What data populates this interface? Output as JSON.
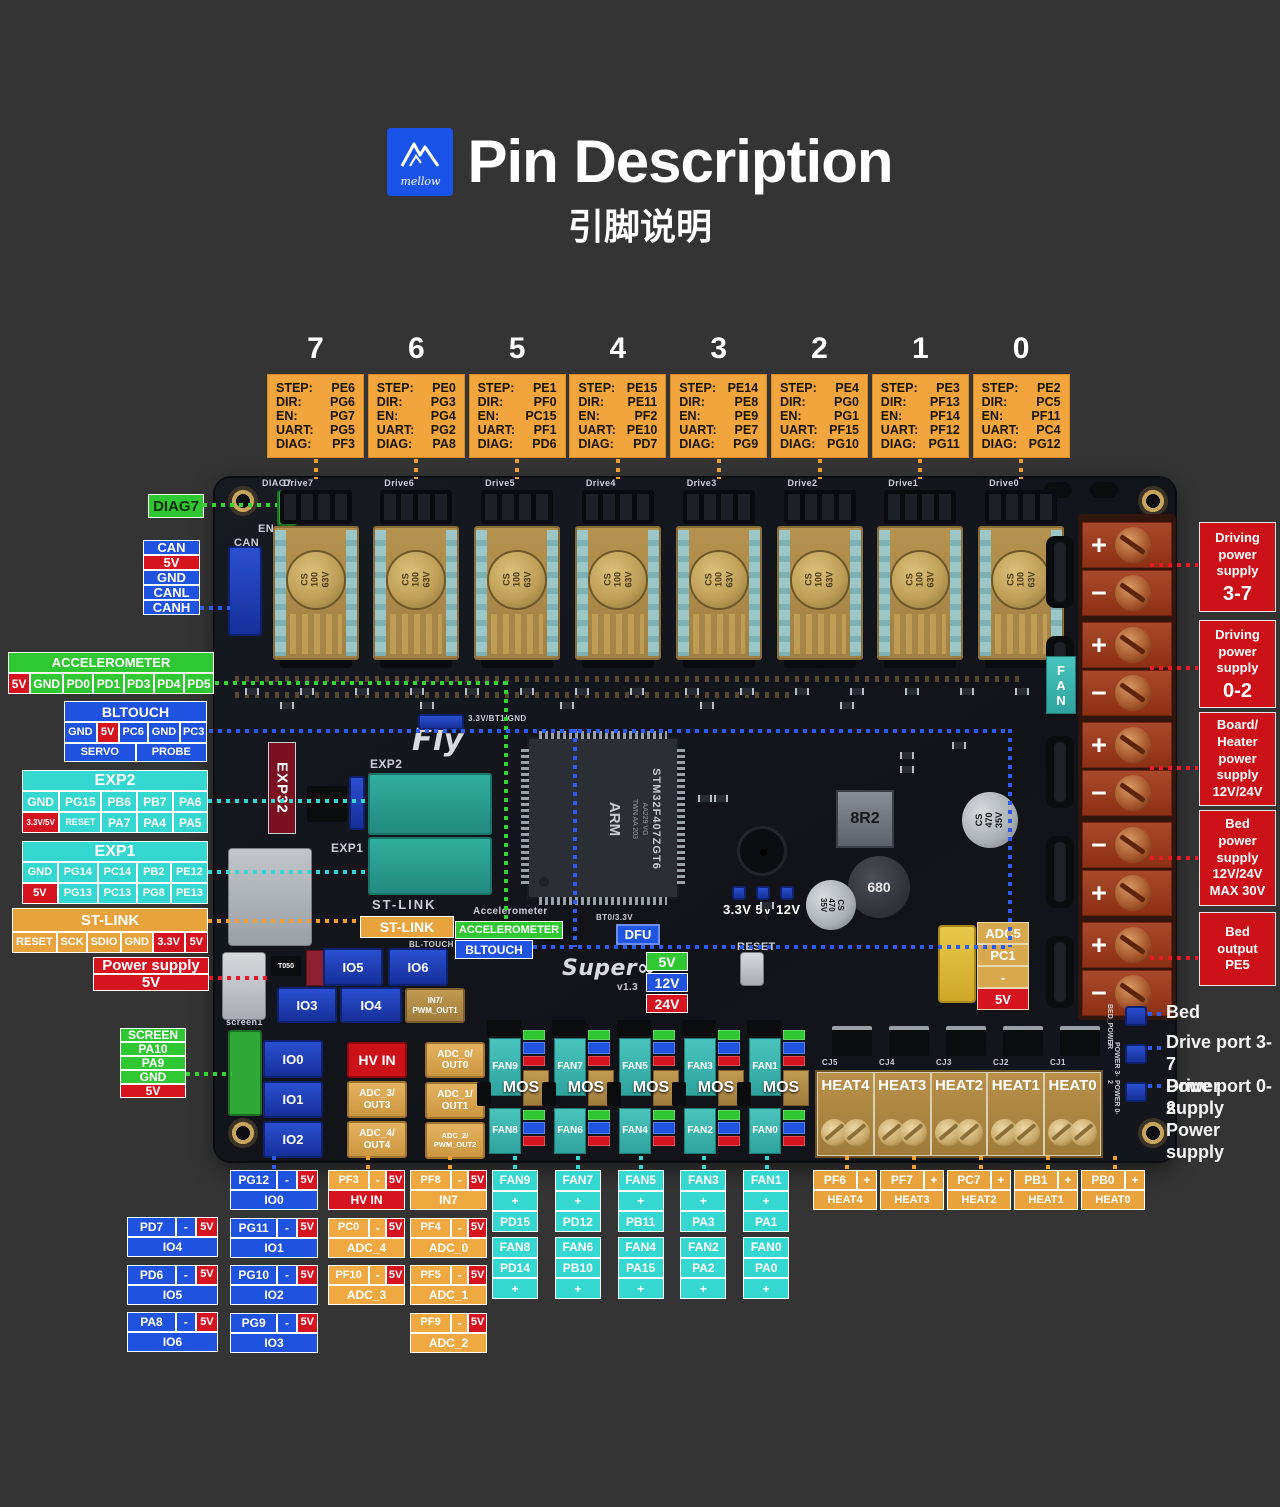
{
  "header": {
    "logo_text": "mellow",
    "title": "Pin Description",
    "subtitle": "引脚说明"
  },
  "drivers": {
    "row_labels": [
      "STEP:",
      "DIR:",
      "EN:",
      "UART:",
      "DIAG:"
    ],
    "items": [
      {
        "num": "7",
        "pins": [
          "PE6",
          "PG6",
          "PG7",
          "PG5",
          "PF3"
        ]
      },
      {
        "num": "6",
        "pins": [
          "PE0",
          "PG3",
          "PG4",
          "PG2",
          "PA8"
        ]
      },
      {
        "num": "5",
        "pins": [
          "PE1",
          "PF0",
          "PC15",
          "PF1",
          "PD6"
        ]
      },
      {
        "num": "4",
        "pins": [
          "PE15",
          "PE11",
          "PF2",
          "PE10",
          "PD7"
        ]
      },
      {
        "num": "3",
        "pins": [
          "PE14",
          "PE8",
          "PE9",
          "PE7",
          "PG9"
        ]
      },
      {
        "num": "2",
        "pins": [
          "PE4",
          "PG0",
          "PG1",
          "PF15",
          "PG10"
        ]
      },
      {
        "num": "1",
        "pins": [
          "PE3",
          "PF13",
          "PF14",
          "PF12",
          "PG11"
        ]
      },
      {
        "num": "0",
        "pins": [
          "PE2",
          "PC5",
          "PF11",
          "PC4",
          "PG12"
        ]
      }
    ]
  },
  "callouts_left": {
    "diag7": "DIAG7",
    "can": [
      "CAN",
      "5V",
      "GND",
      "CANL",
      "CANH"
    ],
    "accelerometer": {
      "title": "ACCELEROMETER",
      "cells": [
        "5V",
        "GND",
        "PD0",
        "PD1",
        "PD3",
        "PD4",
        "PD5"
      ]
    },
    "bltouch": {
      "title": "BLTOUCH",
      "cells": [
        "GND",
        "5V",
        "PC6",
        "GND",
        "PC3"
      ],
      "functions": [
        "SERVO",
        "PROBE"
      ]
    },
    "exp2": {
      "title": "EXP2",
      "row1": [
        "GND",
        "PG15",
        "PB6",
        "PB7",
        "PA6"
      ],
      "row2": [
        "3.3V/5V",
        "RESET",
        "PA7",
        "PA4",
        "PA5"
      ]
    },
    "exp1": {
      "title": "EXP1",
      "row1": [
        "GND",
        "PG14",
        "PC14",
        "PB2",
        "PE12"
      ],
      "row2": [
        "5V",
        "PG13",
        "PC13",
        "PG8",
        "PE13"
      ]
    },
    "stlink": {
      "title": "ST-LINK",
      "cells": [
        "RESET",
        "SCK",
        "SDIO",
        "GND",
        "3.3V",
        "5V"
      ]
    },
    "power_supply": {
      "title": "Power supply",
      "value": "5V"
    },
    "screen": [
      "SCREEN",
      "PA10",
      "PA9",
      "GND",
      "5V"
    ]
  },
  "callouts_right": {
    "boxes": [
      {
        "text": "Driving\npower\nsupply",
        "big": "3-7"
      },
      {
        "text": "Driving\npower\nsupply",
        "big": "0-2"
      },
      {
        "text": "Board/\nHeater\npower\nsupply\n12V/24V",
        "big": ""
      },
      {
        "text": "Bed\npower\nsupply\n12V/24V\nMAX 30V",
        "big": ""
      },
      {
        "text": "Bed\noutput\nPE5",
        "big": ""
      }
    ],
    "notes": [
      {
        "text": "Bed"
      },
      {
        "text": "Drive port 3-7\nPower supply"
      },
      {
        "text": "Drive port 0-2\nPower supply"
      }
    ]
  },
  "board": {
    "socket_labels": [
      "Drive7",
      "Drive6",
      "Drive5",
      "Drive4",
      "Drive3",
      "Drive2",
      "Drive1",
      "Drive0"
    ],
    "diag7_silk": "DIAG7",
    "en_silk": "EN",
    "can_silk": "CAN",
    "cap_lines": "CS\n100\n63V",
    "fan_tab": "FAN",
    "exp32": "EXP32",
    "fly": "Fly",
    "exp2_silk": "EXP2",
    "exp1_silk": "EXP1",
    "jumper_silk": "3.3V/BT1/GND",
    "chip": {
      "marking": "STM32F407ZGT6",
      "sub": "AA229 VG\nTWN AA 203",
      "arm": "ARM"
    },
    "stlink_silk": "ST-LINK",
    "stlink_label": "ST-LINK",
    "accel_silk": "Accelerometer",
    "accel_label": "ACCELEROMETER",
    "bltouch_silk": "BL-TOUCH",
    "bltouch_label": "BLTOUCH",
    "leds_label": "3.3V 5V 12V",
    "dfu_silk": "BT0/3.3V",
    "dfu_label": "DFU",
    "reset_silk": "RESET",
    "super_silk": "Super∞",
    "version_silk": "v1.3",
    "voltage_options": [
      "5V",
      "12V",
      "24V"
    ],
    "adc5_cells": [
      "ADC5",
      "PC1",
      "-",
      "5V"
    ],
    "inductor1": "8R2",
    "inductor2": "680",
    "cap470": "CS\n470\n35V",
    "t050": "T050",
    "screen_silk": "screen1",
    "io_connectors": [
      "IO0",
      "IO1",
      "IO2",
      "IO3",
      "IO4",
      "IO5",
      "IO6"
    ],
    "in7_label": "IN7/\nPWM_OUT1",
    "hv_in": "HV IN",
    "adc_left": [
      "ADC_3/\nOUT3",
      "ADC_4/\nOUT4"
    ],
    "adc_right": [
      "ADC_0/\nOUT0",
      "ADC_1/\nOUT1",
      "ADC_2/\nPWM_OUT2"
    ],
    "fan_cols": [
      {
        "top": "FAN9",
        "bottom": "FAN8"
      },
      {
        "top": "FAN7",
        "bottom": "FAN6"
      },
      {
        "top": "FAN5",
        "bottom": "FAN4"
      },
      {
        "top": "FAN3",
        "bottom": "FAN2"
      },
      {
        "top": "FAN1",
        "bottom": "FAN0"
      }
    ],
    "mos": "MOS",
    "heat_silk": [
      "CJ5",
      "CJ4",
      "CJ3",
      "CJ2",
      "CJ1"
    ],
    "heat_cells": [
      "HEAT4",
      "HEAT3",
      "HEAT2",
      "HEAT1",
      "HEAT0"
    ],
    "bed_silk": [
      "BED_POWER",
      "POWER 3-7",
      "POWER 0-2"
    ],
    "terminal_groups": [
      [
        "+",
        "−"
      ],
      [
        "+",
        "−"
      ],
      [
        "+",
        "−"
      ],
      [
        "−",
        "+"
      ],
      [
        "+",
        "−"
      ]
    ]
  },
  "bottom_tables": {
    "dash": "-",
    "v5": "5V",
    "plus": "+",
    "io_left": [
      {
        "pin": "PD7",
        "name": "IO4"
      },
      {
        "pin": "PD6",
        "name": "IO5"
      },
      {
        "pin": "PA8",
        "name": "IO6"
      }
    ],
    "io_mid": [
      {
        "pin": "PG12",
        "name": "IO0"
      },
      {
        "pin": "PG11",
        "name": "IO1"
      },
      {
        "pin": "PG10",
        "name": "IO2"
      },
      {
        "pin": "PG9",
        "name": "IO3"
      }
    ],
    "col3": [
      {
        "pin": "PF3",
        "name": "HV IN",
        "name_style": "red"
      },
      {
        "pin": "PC0",
        "name": "ADC_4",
        "name_style": "orange"
      },
      {
        "pin": "PF10",
        "name": "ADC_3",
        "name_style": "orange"
      }
    ],
    "col4": [
      {
        "pin": "PF8",
        "name": "IN7"
      },
      {
        "pin": "PF4",
        "name": "ADC_0"
      },
      {
        "pin": "PF5",
        "name": "ADC_1"
      },
      {
        "pin": "PF9",
        "name": "ADC_2"
      }
    ],
    "fans": [
      {
        "top": [
          "FAN9",
          "+",
          "PD15"
        ],
        "bottom": [
          "FAN8",
          "PD14",
          "+"
        ]
      },
      {
        "top": [
          "FAN7",
          "+",
          "PD12"
        ],
        "bottom": [
          "FAN6",
          "PB10",
          "+"
        ]
      },
      {
        "top": [
          "FAN5",
          "+",
          "PB11"
        ],
        "bottom": [
          "FAN4",
          "PA15",
          "+"
        ]
      },
      {
        "top": [
          "FAN3",
          "+",
          "PA3"
        ],
        "bottom": [
          "FAN2",
          "PA2",
          "+"
        ]
      },
      {
        "top": [
          "FAN1",
          "+",
          "PA1"
        ],
        "bottom": [
          "FAN0",
          "PA0",
          "+"
        ]
      }
    ],
    "heats": [
      {
        "pin": "PF6",
        "name": "HEAT4"
      },
      {
        "pin": "PF7",
        "name": "HEAT3"
      },
      {
        "pin": "PC7",
        "name": "HEAT2"
      },
      {
        "pin": "PB1",
        "name": "HEAT1"
      },
      {
        "pin": "PB0",
        "name": "HEAT0"
      }
    ]
  }
}
